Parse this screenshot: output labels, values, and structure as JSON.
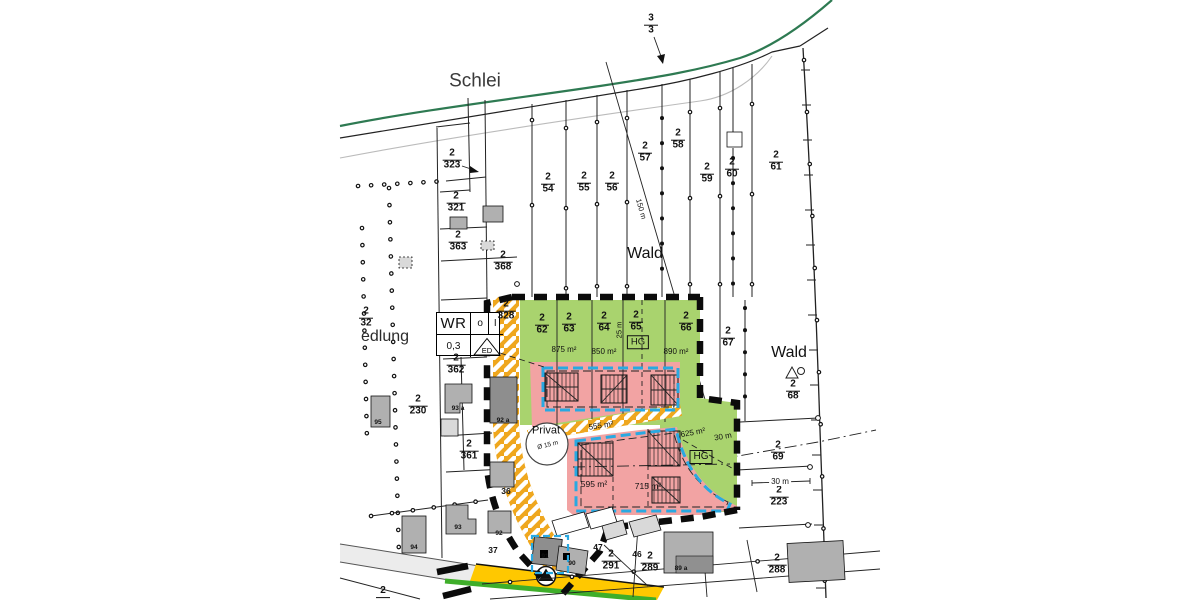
{
  "colors": {
    "green": "#a9d36e",
    "pink": "#f2a3a3",
    "road_orange": "#efa71e",
    "road_yellow": "#ffc800",
    "road_green_edge": "#3fae2a",
    "boundary_blue": "#29a9e1",
    "shore_green": "#2e7a52",
    "building_gray": "#b0b0b0",
    "plan_boundary": "#0b0b0b"
  },
  "zoning_box": {
    "use": "WR",
    "bauweise": "o",
    "storeys": "I",
    "grz": "0,3",
    "haustyp": "ED"
  },
  "parcel_labels": [
    {
      "name": "parcel-3-3",
      "num": "3",
      "den": "3",
      "x": 651,
      "y": 25
    },
    {
      "name": "parcel-2-323",
      "num": "2",
      "den": "323",
      "x": 452,
      "y": 160
    },
    {
      "name": "parcel-2-321",
      "num": "2",
      "den": "321",
      "x": 456,
      "y": 203
    },
    {
      "name": "parcel-2-363",
      "num": "2",
      "den": "363",
      "x": 458,
      "y": 242
    },
    {
      "name": "parcel-2-368",
      "num": "2",
      "den": "368",
      "x": 503,
      "y": 262
    },
    {
      "name": "parcel-2-328",
      "num": "2",
      "den": "328",
      "x": 506,
      "y": 311
    },
    {
      "name": "parcel-2-362",
      "num": "2",
      "den": "362",
      "x": 456,
      "y": 365
    },
    {
      "name": "parcel-2-230",
      "num": "2",
      "den": "230",
      "x": 418,
      "y": 406
    },
    {
      "name": "parcel-2-361",
      "num": "2",
      "den": "361",
      "x": 469,
      "y": 451
    },
    {
      "name": "parcel-2-32",
      "num": "2",
      "den": "32",
      "x": 366,
      "y": 318
    },
    {
      "name": "parcel-2-54",
      "num": "2",
      "den": "54",
      "x": 548,
      "y": 184
    },
    {
      "name": "parcel-2-55",
      "num": "2",
      "den": "55",
      "x": 584,
      "y": 183
    },
    {
      "name": "parcel-2-56",
      "num": "2",
      "den": "56",
      "x": 612,
      "y": 183
    },
    {
      "name": "parcel-2-57",
      "num": "2",
      "den": "57",
      "x": 645,
      "y": 153
    },
    {
      "name": "parcel-2-58",
      "num": "2",
      "den": "58",
      "x": 678,
      "y": 140
    },
    {
      "name": "parcel-2-59",
      "num": "2",
      "den": "59",
      "x": 707,
      "y": 174
    },
    {
      "name": "parcel-2-60",
      "num": "2",
      "den": "60",
      "x": 732,
      "y": 169
    },
    {
      "name": "parcel-2-61",
      "num": "2",
      "den": "61",
      "x": 776,
      "y": 162
    },
    {
      "name": "parcel-2-62",
      "num": "2",
      "den": "62",
      "x": 542,
      "y": 325
    },
    {
      "name": "parcel-2-63",
      "num": "2",
      "den": "63",
      "x": 569,
      "y": 324
    },
    {
      "name": "parcel-2-64",
      "num": "2",
      "den": "64",
      "x": 604,
      "y": 323
    },
    {
      "name": "parcel-2-65",
      "num": "2",
      "den": "65",
      "x": 636,
      "y": 322
    },
    {
      "name": "parcel-2-66",
      "num": "2",
      "den": "66",
      "x": 686,
      "y": 323
    },
    {
      "name": "parcel-2-67",
      "num": "2",
      "den": "67",
      "x": 728,
      "y": 338
    },
    {
      "name": "parcel-2-68",
      "num": "2",
      "den": "68",
      "x": 793,
      "y": 391
    },
    {
      "name": "parcel-2-69",
      "num": "2",
      "den": "69",
      "x": 778,
      "y": 452
    },
    {
      "name": "parcel-2-223",
      "num": "2",
      "den": "223",
      "x": 779,
      "y": 497
    },
    {
      "name": "parcel-2-288",
      "num": "2",
      "den": "288",
      "x": 777,
      "y": 565
    },
    {
      "name": "parcel-2-291",
      "num": "2",
      "den": "291",
      "x": 611,
      "y": 561
    },
    {
      "name": "parcel-2-289",
      "num": "2",
      "den": "289",
      "x": 650,
      "y": 563
    },
    {
      "name": "parcel-edge-cut",
      "num": "2",
      "den": "",
      "x": 383,
      "y": 592
    }
  ],
  "static_labels": [
    {
      "name": "water-label",
      "text": "Schlei",
      "x": 475,
      "y": 81,
      "size": 19,
      "color": "#3a3a3a"
    },
    {
      "name": "forest-label-top",
      "text": "Wald",
      "x": 645,
      "y": 254,
      "size": 16
    },
    {
      "name": "forest-label-right",
      "text": "Wald",
      "x": 789,
      "y": 353,
      "size": 16
    },
    {
      "name": "settlement-label",
      "text": "edlung",
      "x": 385,
      "y": 337,
      "size": 16,
      "color": "#2b2b2b"
    },
    {
      "name": "privat-label",
      "text": "Privat",
      "x": 546,
      "y": 431,
      "size": 11
    },
    {
      "name": "privat-diameter",
      "text": "Ø 15 m",
      "x": 548,
      "y": 446,
      "size": 6.5,
      "rot": -14
    },
    {
      "name": "area-875",
      "text": "875 m²",
      "x": 564,
      "y": 350,
      "size": 8
    },
    {
      "name": "area-850",
      "text": "850 m²",
      "x": 604,
      "y": 352,
      "size": 8
    },
    {
      "name": "area-890",
      "text": "890 m²",
      "x": 676,
      "y": 352,
      "size": 8
    },
    {
      "name": "area-555",
      "text": "555 m²",
      "x": 601,
      "y": 426,
      "size": 8,
      "rot": -8
    },
    {
      "name": "area-595",
      "text": "595 m²",
      "x": 594,
      "y": 484,
      "size": 8.5
    },
    {
      "name": "area-715",
      "text": "715 m²",
      "x": 648,
      "y": 486,
      "size": 8.5
    },
    {
      "name": "area-625",
      "text": "625 m²",
      "x": 693,
      "y": 433,
      "size": 8,
      "rot": -10
    },
    {
      "name": "measure-30m-lobe",
      "text": "30 m",
      "x": 723,
      "y": 437,
      "size": 8,
      "rot": -10
    },
    {
      "name": "measure-30m-right",
      "text": "30 m",
      "x": 780,
      "y": 482,
      "size": 8,
      "bg": true
    },
    {
      "name": "measure-25m",
      "text": "25 m",
      "x": 619,
      "y": 330,
      "size": 7.5,
      "rot": -90
    },
    {
      "name": "measure-150m",
      "text": "150 m",
      "x": 641,
      "y": 209,
      "size": 7.5,
      "rot": 74
    },
    {
      "name": "hg-upper",
      "text": "HG",
      "x": 638,
      "y": 342,
      "size": 9.5,
      "box": true
    },
    {
      "name": "hg-lower",
      "text": "HG",
      "x": 701,
      "y": 457,
      "size": 10,
      "box": true
    },
    {
      "name": "house-95",
      "text": "95",
      "x": 378,
      "y": 423,
      "size": 6.5,
      "bold": true
    },
    {
      "name": "house-93a",
      "text": "93 a",
      "x": 458,
      "y": 409,
      "size": 6.5,
      "bold": true
    },
    {
      "name": "house-92a",
      "text": "92 a",
      "x": 503,
      "y": 421,
      "size": 6.5,
      "bold": true
    },
    {
      "name": "house-36",
      "text": "36",
      "x": 506,
      "y": 491,
      "size": 8.5,
      "bold": true
    },
    {
      "name": "house-37",
      "text": "37",
      "x": 493,
      "y": 550,
      "size": 8.5,
      "bold": true
    },
    {
      "name": "house-93",
      "text": "93",
      "x": 458,
      "y": 528,
      "size": 6.5,
      "bold": true
    },
    {
      "name": "house-94",
      "text": "94",
      "x": 414,
      "y": 548,
      "size": 6.5,
      "bold": true
    },
    {
      "name": "house-92",
      "text": "92",
      "x": 499,
      "y": 534,
      "size": 6.5,
      "bold": true
    },
    {
      "name": "house-91",
      "text": "91",
      "x": 545,
      "y": 557,
      "size": 6.5,
      "bold": true
    },
    {
      "name": "house-90",
      "text": "90",
      "x": 572,
      "y": 564,
      "size": 6.5,
      "bold": true
    },
    {
      "name": "house-89a",
      "text": "89 a",
      "x": 681,
      "y": 569,
      "size": 6.5,
      "bold": true
    },
    {
      "name": "house-47",
      "text": "47",
      "x": 598,
      "y": 547,
      "size": 8.5,
      "bold": true
    },
    {
      "name": "house-46",
      "text": "46",
      "x": 637,
      "y": 554,
      "size": 8.5,
      "bold": true
    }
  ]
}
